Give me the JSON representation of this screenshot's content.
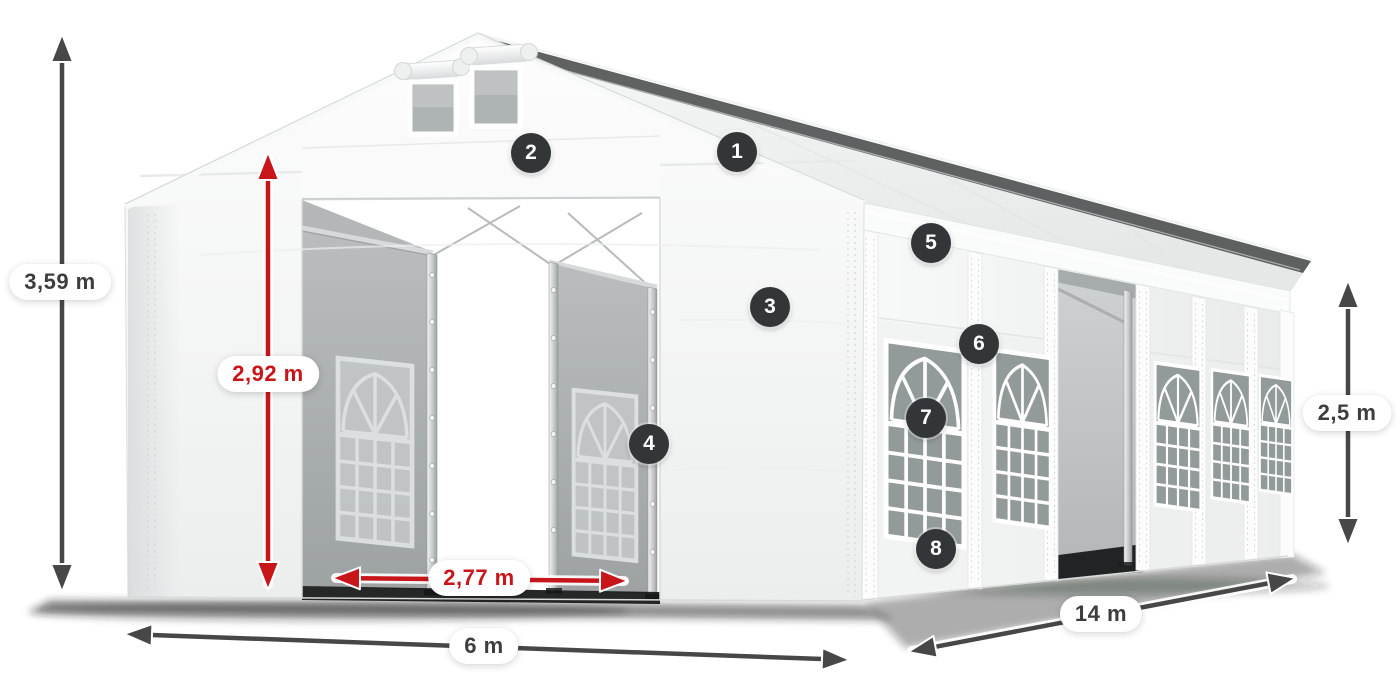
{
  "diagram": {
    "title": "Tent dimension diagram",
    "subject": "White marquee tent 6 x 14 m with numbered feature callouts and dimension arrows",
    "dimensions": [
      {
        "id": "total-height",
        "text": "3,59 m",
        "style": "gray"
      },
      {
        "id": "entrance-height",
        "text": "2,92 m",
        "style": "red"
      },
      {
        "id": "entrance-width",
        "text": "2,77 m",
        "style": "red"
      },
      {
        "id": "front-width",
        "text": "6 m",
        "style": "gray"
      },
      {
        "id": "side-length",
        "text": "14 m",
        "style": "gray"
      },
      {
        "id": "side-height",
        "text": "2,5 m",
        "style": "gray"
      }
    ],
    "callouts": [
      {
        "number": "1"
      },
      {
        "number": "2"
      },
      {
        "number": "3"
      },
      {
        "number": "4"
      },
      {
        "number": "5"
      },
      {
        "number": "6"
      },
      {
        "number": "7"
      },
      {
        "number": "8"
      }
    ],
    "colors": {
      "dimension_red": "#c8151a",
      "dimension_gray": "#3d3d3d",
      "arrow_gray": "#474747",
      "callout_badge": "#333639",
      "fabric": "#f4f5f5"
    }
  }
}
